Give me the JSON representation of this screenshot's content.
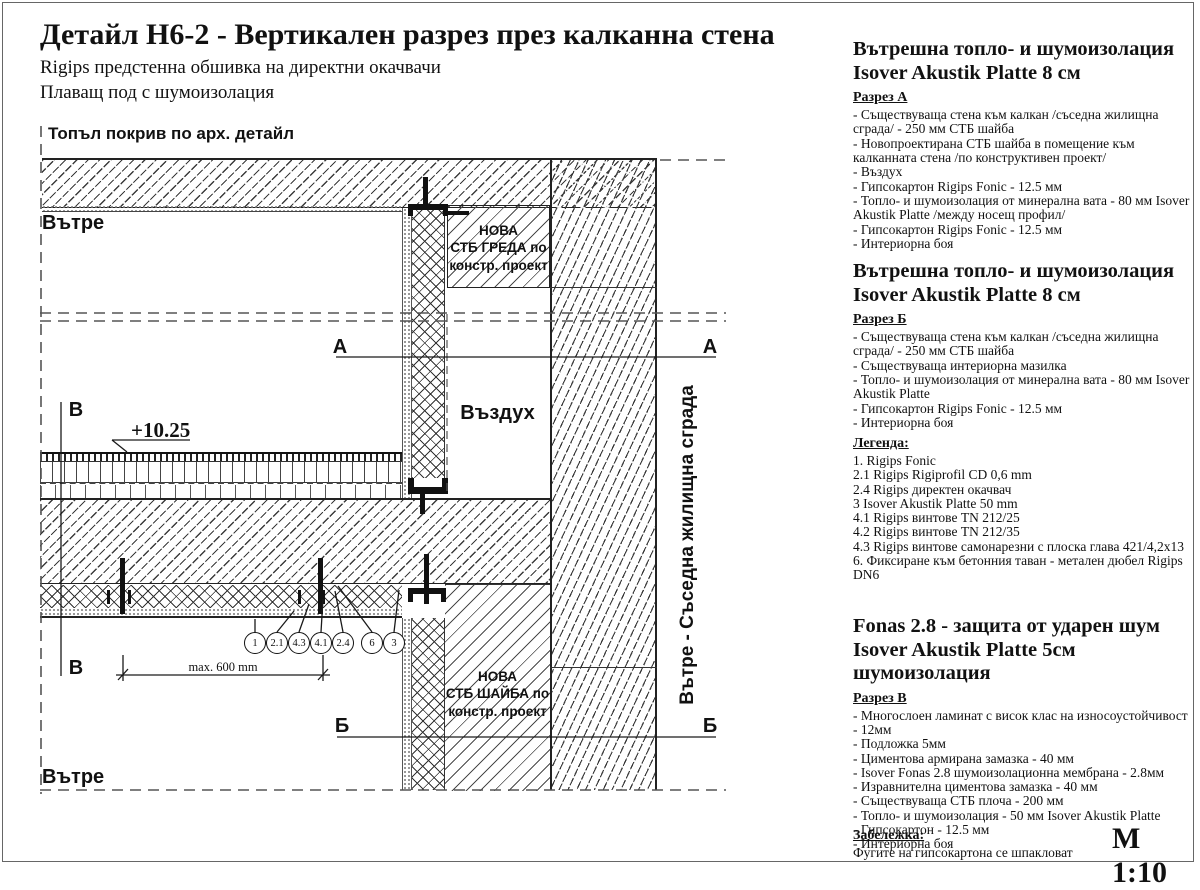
{
  "page": {
    "title": "Детайл Н6-2 - Вертикален разрез през калканна стена",
    "subtitle1": "Rigips предстенна обшивка на директни окачвачи",
    "subtitle2": "Плаващ под с шумоизолация",
    "scale": "М 1:10"
  },
  "drawing": {
    "roof_label": "Топъл покрив по арх. детайл",
    "inside_top": "Вътре",
    "inside_bottom": "Вътре",
    "neighbor_label": "Вътре - Съседна жилищна сграда",
    "air_label": "Въздух",
    "beam_label_lines": [
      "НОВА",
      "СТБ ГРЕДА по",
      "констр. проект"
    ],
    "wall_label_lines": [
      "НОВА",
      "СТБ ШАЙБА по",
      "констр. проект"
    ],
    "level_mark": "+10.25",
    "dim_label": "max. 600 mm",
    "callouts": [
      "1",
      "2.1",
      "4.3",
      "4.1",
      "2.4",
      "6",
      "3"
    ],
    "section_a": "А",
    "section_b": "Б",
    "section_v": "В"
  },
  "panel": {
    "sections": [
      {
        "heading1": "Вътрешна топло- и шумоизолация",
        "heading2": "Isover Akustik Platte 8 см",
        "cut": "Разрез А",
        "items": [
          "- Съществуваща стена към калкан /съседна жилищна сграда/ - 250 мм СТБ шайба",
          "- Новопроектирана СТБ шайба в помещение към калканната стена /по конструктивен проект/",
          "- Въздух",
          "- Гипсокартон Rigips Fonic  - 12.5 мм",
          "- Топло- и шумоизолация от минерална вата - 80 мм Isover Akustik Platte /между носещ профил/",
          "- Гипсокартон Rigips Fonic  - 12.5 мм",
          "- Интериорна боя"
        ]
      },
      {
        "heading1": "Вътрешна топло- и шумоизолация",
        "heading2": "Isover Akustik Platte 8 см",
        "cut": "Разрез Б",
        "items": [
          "- Съществуваща стена към калкан /съседна жилищна сграда/ - 250 мм СТБ шайба",
          "- Съществуваща интериорна мазилка",
          "- Топло- и шумоизолация от минерална вата - 80 мм Isover Akustik Platte",
          "- Гипсокартон Rigips Fonic  - 12.5 мм",
          "- Интериорна боя"
        ]
      }
    ],
    "legend": {
      "title": "Легенда:",
      "items": [
        "1. Rigips Fonic",
        "2.1 Rigips Rigiprofil CD 0,6 mm",
        "2.4 Rigips директен окачвач",
        "3 Isover Akustik Platte 50 mm",
        "4.1 Rigips винтове TN 212/25",
        "4.2 Rigips винтове TN 212/35",
        "4.3 Rigips винтове самонарезни с плоска глава 421/4,2x13",
        "6. Фиксиране към бетонния таван - метален дюбел Rigips DN6"
      ]
    },
    "fonas": {
      "heading1": "Fonas 2.8 - защита от ударен шум",
      "heading2": "Isover Akustik Platte 5см шумоизолация",
      "cut": "Разрез В",
      "items": [
        "- Многослоен ламинат с висок клас на износоустойчивост - 12мм",
        "- Подложка 5мм",
        "- Циментова армирана замазка - 40 мм",
        "- Isover Fonas 2.8 шумоизолационна мембрана - 2.8мм",
        "- Изравнителна циментова замазка - 40 мм",
        "- Съществуваща СТБ плоча - 200 мм",
        "- Топло- и шумоизолация - 50 мм Isover Akustik Platte",
        "- Гипсокартон - 12.5 мм",
        "- Интериорна боя"
      ]
    },
    "note": {
      "title": "Забележка:",
      "text": "Фугите на гипсокартона се шпакловат"
    }
  }
}
